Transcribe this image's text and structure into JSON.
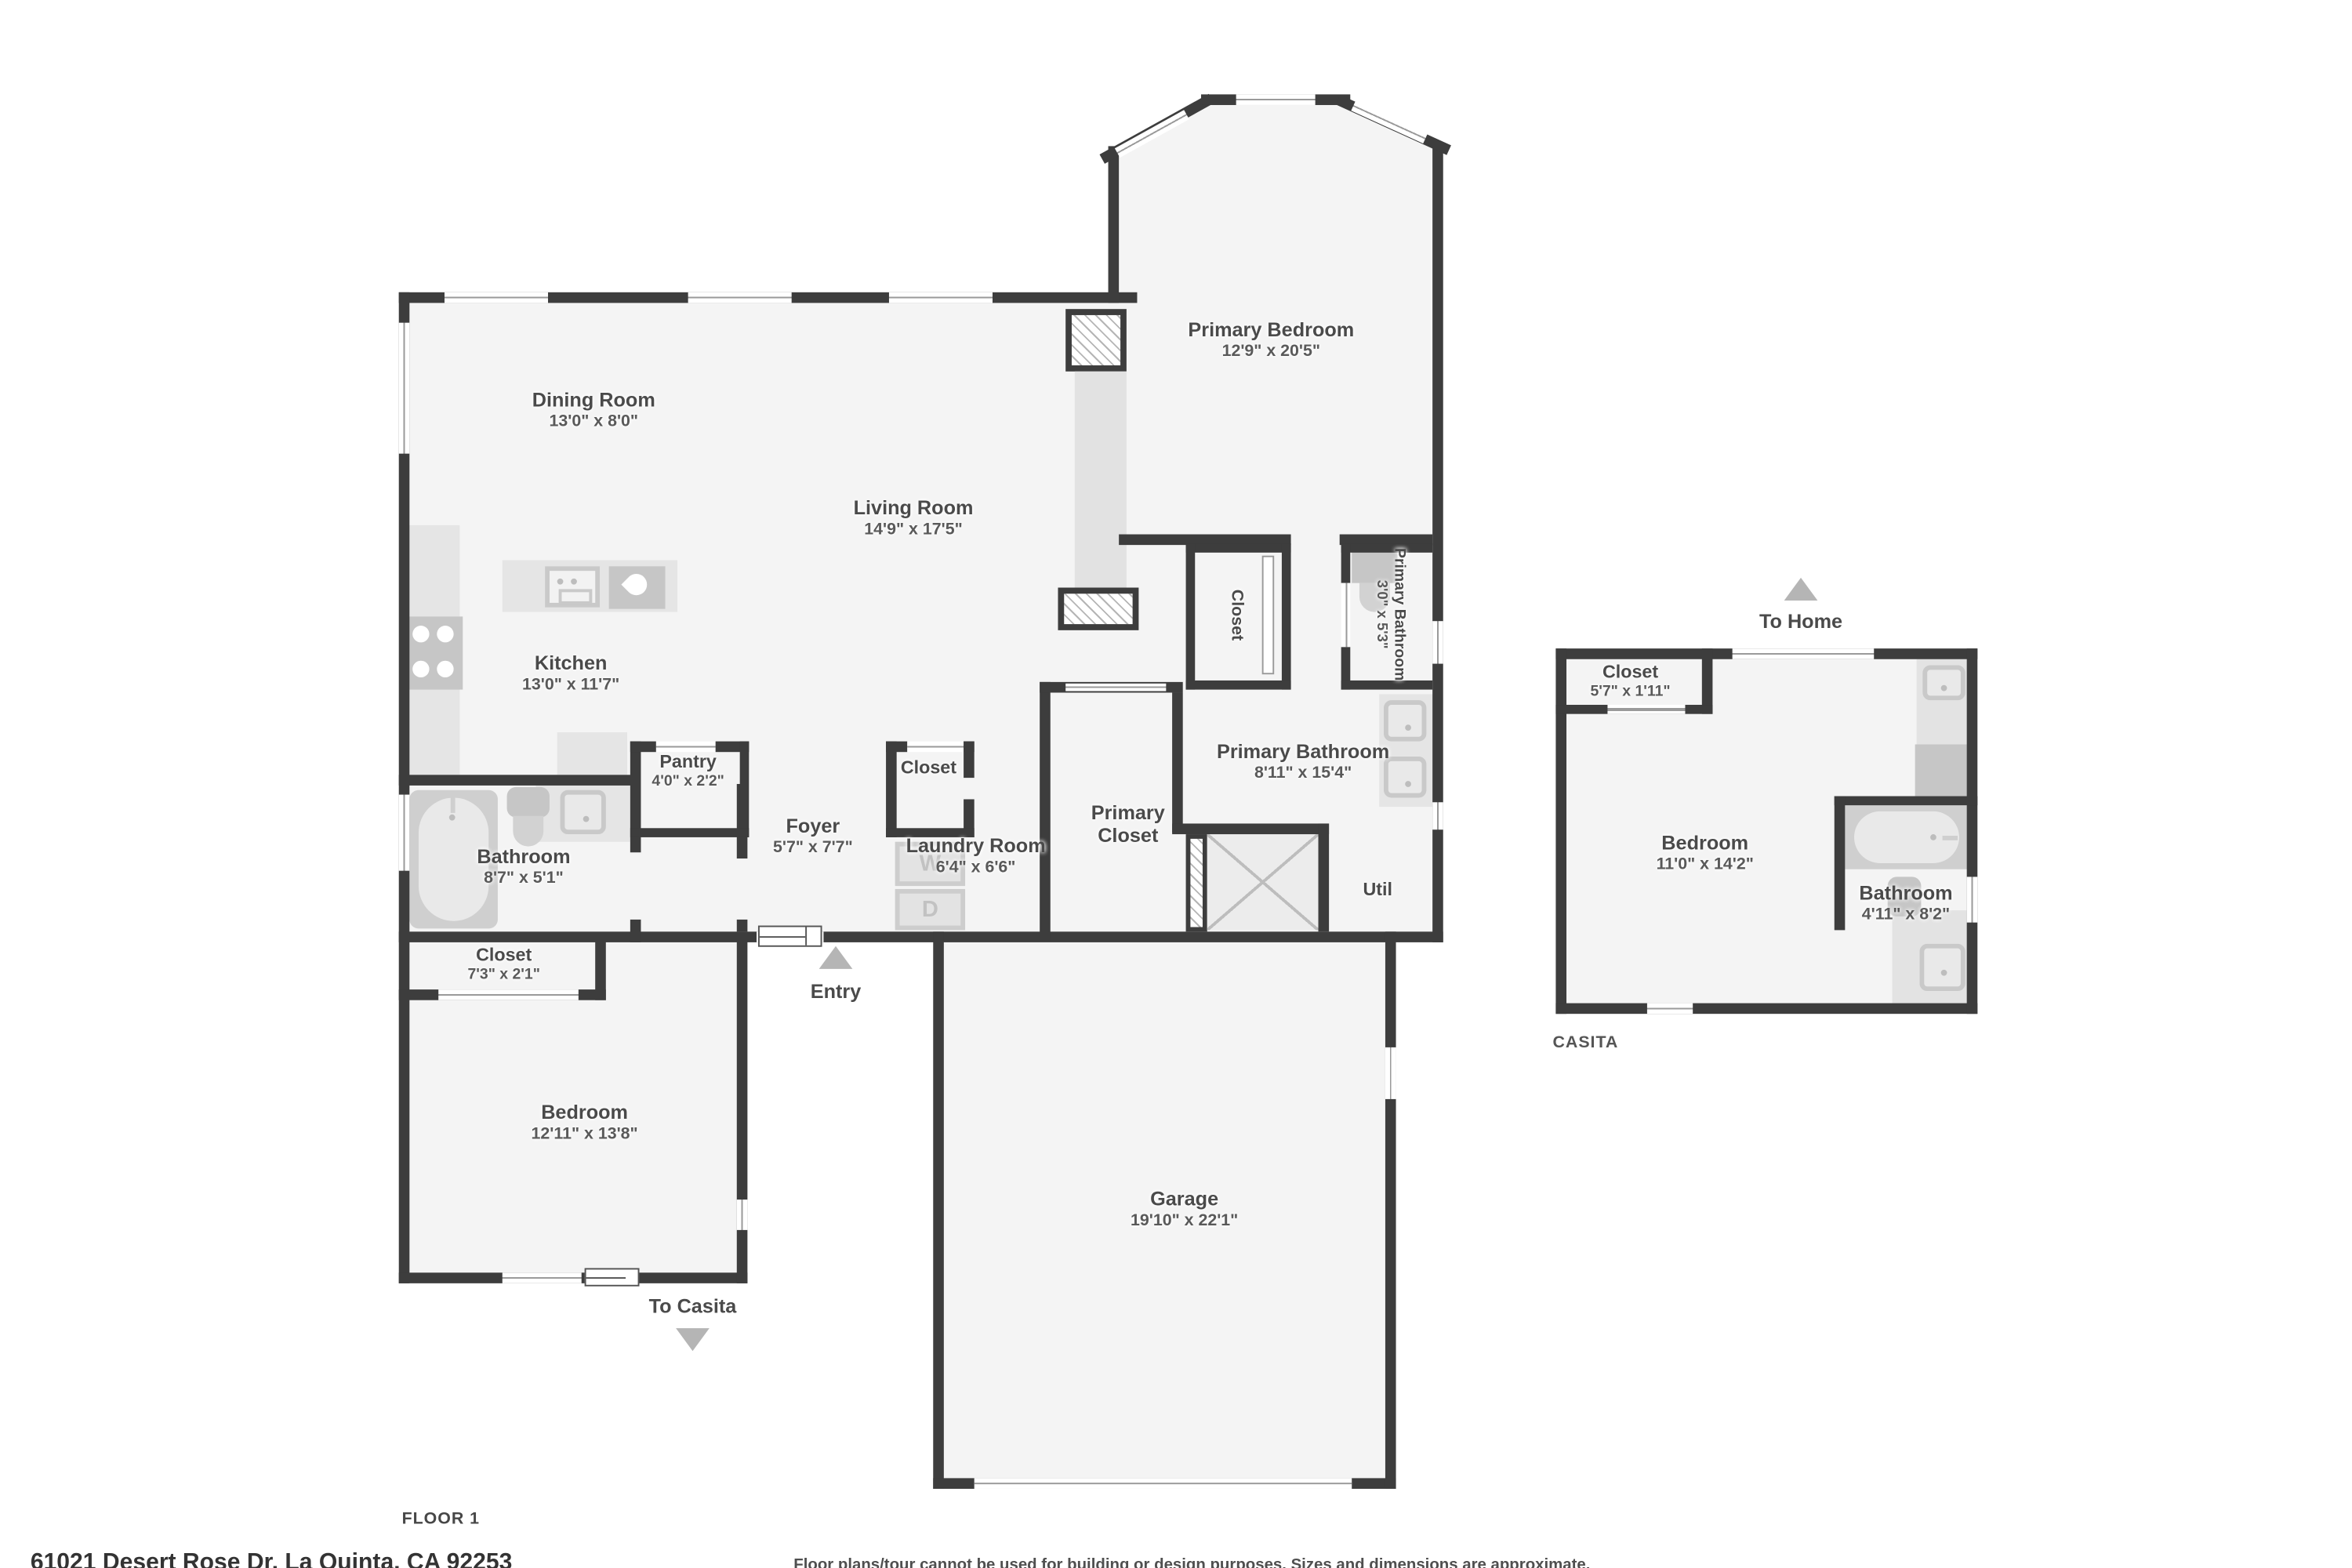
{
  "colors": {
    "wall": "#3d3d3d",
    "floor": "#f4f4f4",
    "fixture": "#d8d8d8",
    "arrow": "#b5b5b5",
    "label_text": "#4a4a4a"
  },
  "rooms": {
    "dining": {
      "name": "Dining Room",
      "dims": "13'0\" x 8'0\""
    },
    "living": {
      "name": "Living Room",
      "dims": "14'9\" x 17'5\""
    },
    "kitchen": {
      "name": "Kitchen",
      "dims": "13'0\" x 11'7\""
    },
    "pantry": {
      "name": "Pantry",
      "dims": "4'0\" x 2'2\""
    },
    "foyer": {
      "name": "Foyer",
      "dims": "5'7\" x 7'7\""
    },
    "foyer_closet": {
      "name": "Closet"
    },
    "laundry": {
      "name": "Laundry Room",
      "dims": "6'4\" x 6'6\""
    },
    "bathroom": {
      "name": "Bathroom",
      "dims": "8'7\" x 5'1\""
    },
    "hall_closet": {
      "name": "Closet",
      "dims": "7'3\" x 2'1\""
    },
    "bedroom": {
      "name": "Bedroom",
      "dims": "12'11\" x 13'8\""
    },
    "garage": {
      "name": "Garage",
      "dims": "19'10\" x 22'1\""
    },
    "primary_bedroom": {
      "name": "Primary Bedroom",
      "dims": "12'9\" x 20'5\""
    },
    "primary_bed_closet": {
      "name": "Closet"
    },
    "primary_bath_small": {
      "name": "Primary Bathroom",
      "dims": "3'0\" x 5'3\""
    },
    "primary_bathroom": {
      "name": "Primary Bathroom",
      "dims": "8'11\" x 15'4\""
    },
    "primary_closet": {
      "name": "Primary Closet"
    },
    "util": {
      "name": "Util"
    }
  },
  "laundry_appliances": {
    "washer": "W",
    "dryer": "D"
  },
  "arrows": {
    "entry": "Entry",
    "to_casita": "To Casita",
    "to_home": "To Home"
  },
  "casita": {
    "title": "CASITA",
    "closet": {
      "name": "Closet",
      "dims": "5'7\" x 1'11\""
    },
    "bedroom": {
      "name": "Bedroom",
      "dims": "11'0\" x 14'2\""
    },
    "bathroom": {
      "name": "Bathroom",
      "dims": "4'11\" x 8'2\""
    }
  },
  "footer": {
    "floor_label": "FLOOR 1",
    "address": "61021 Desert Rose Dr, La Quinta, CA 92253",
    "disclaimer": "Floor plans/tour cannot be used for building or design purposes. Sizes and dimensions are approximate."
  }
}
